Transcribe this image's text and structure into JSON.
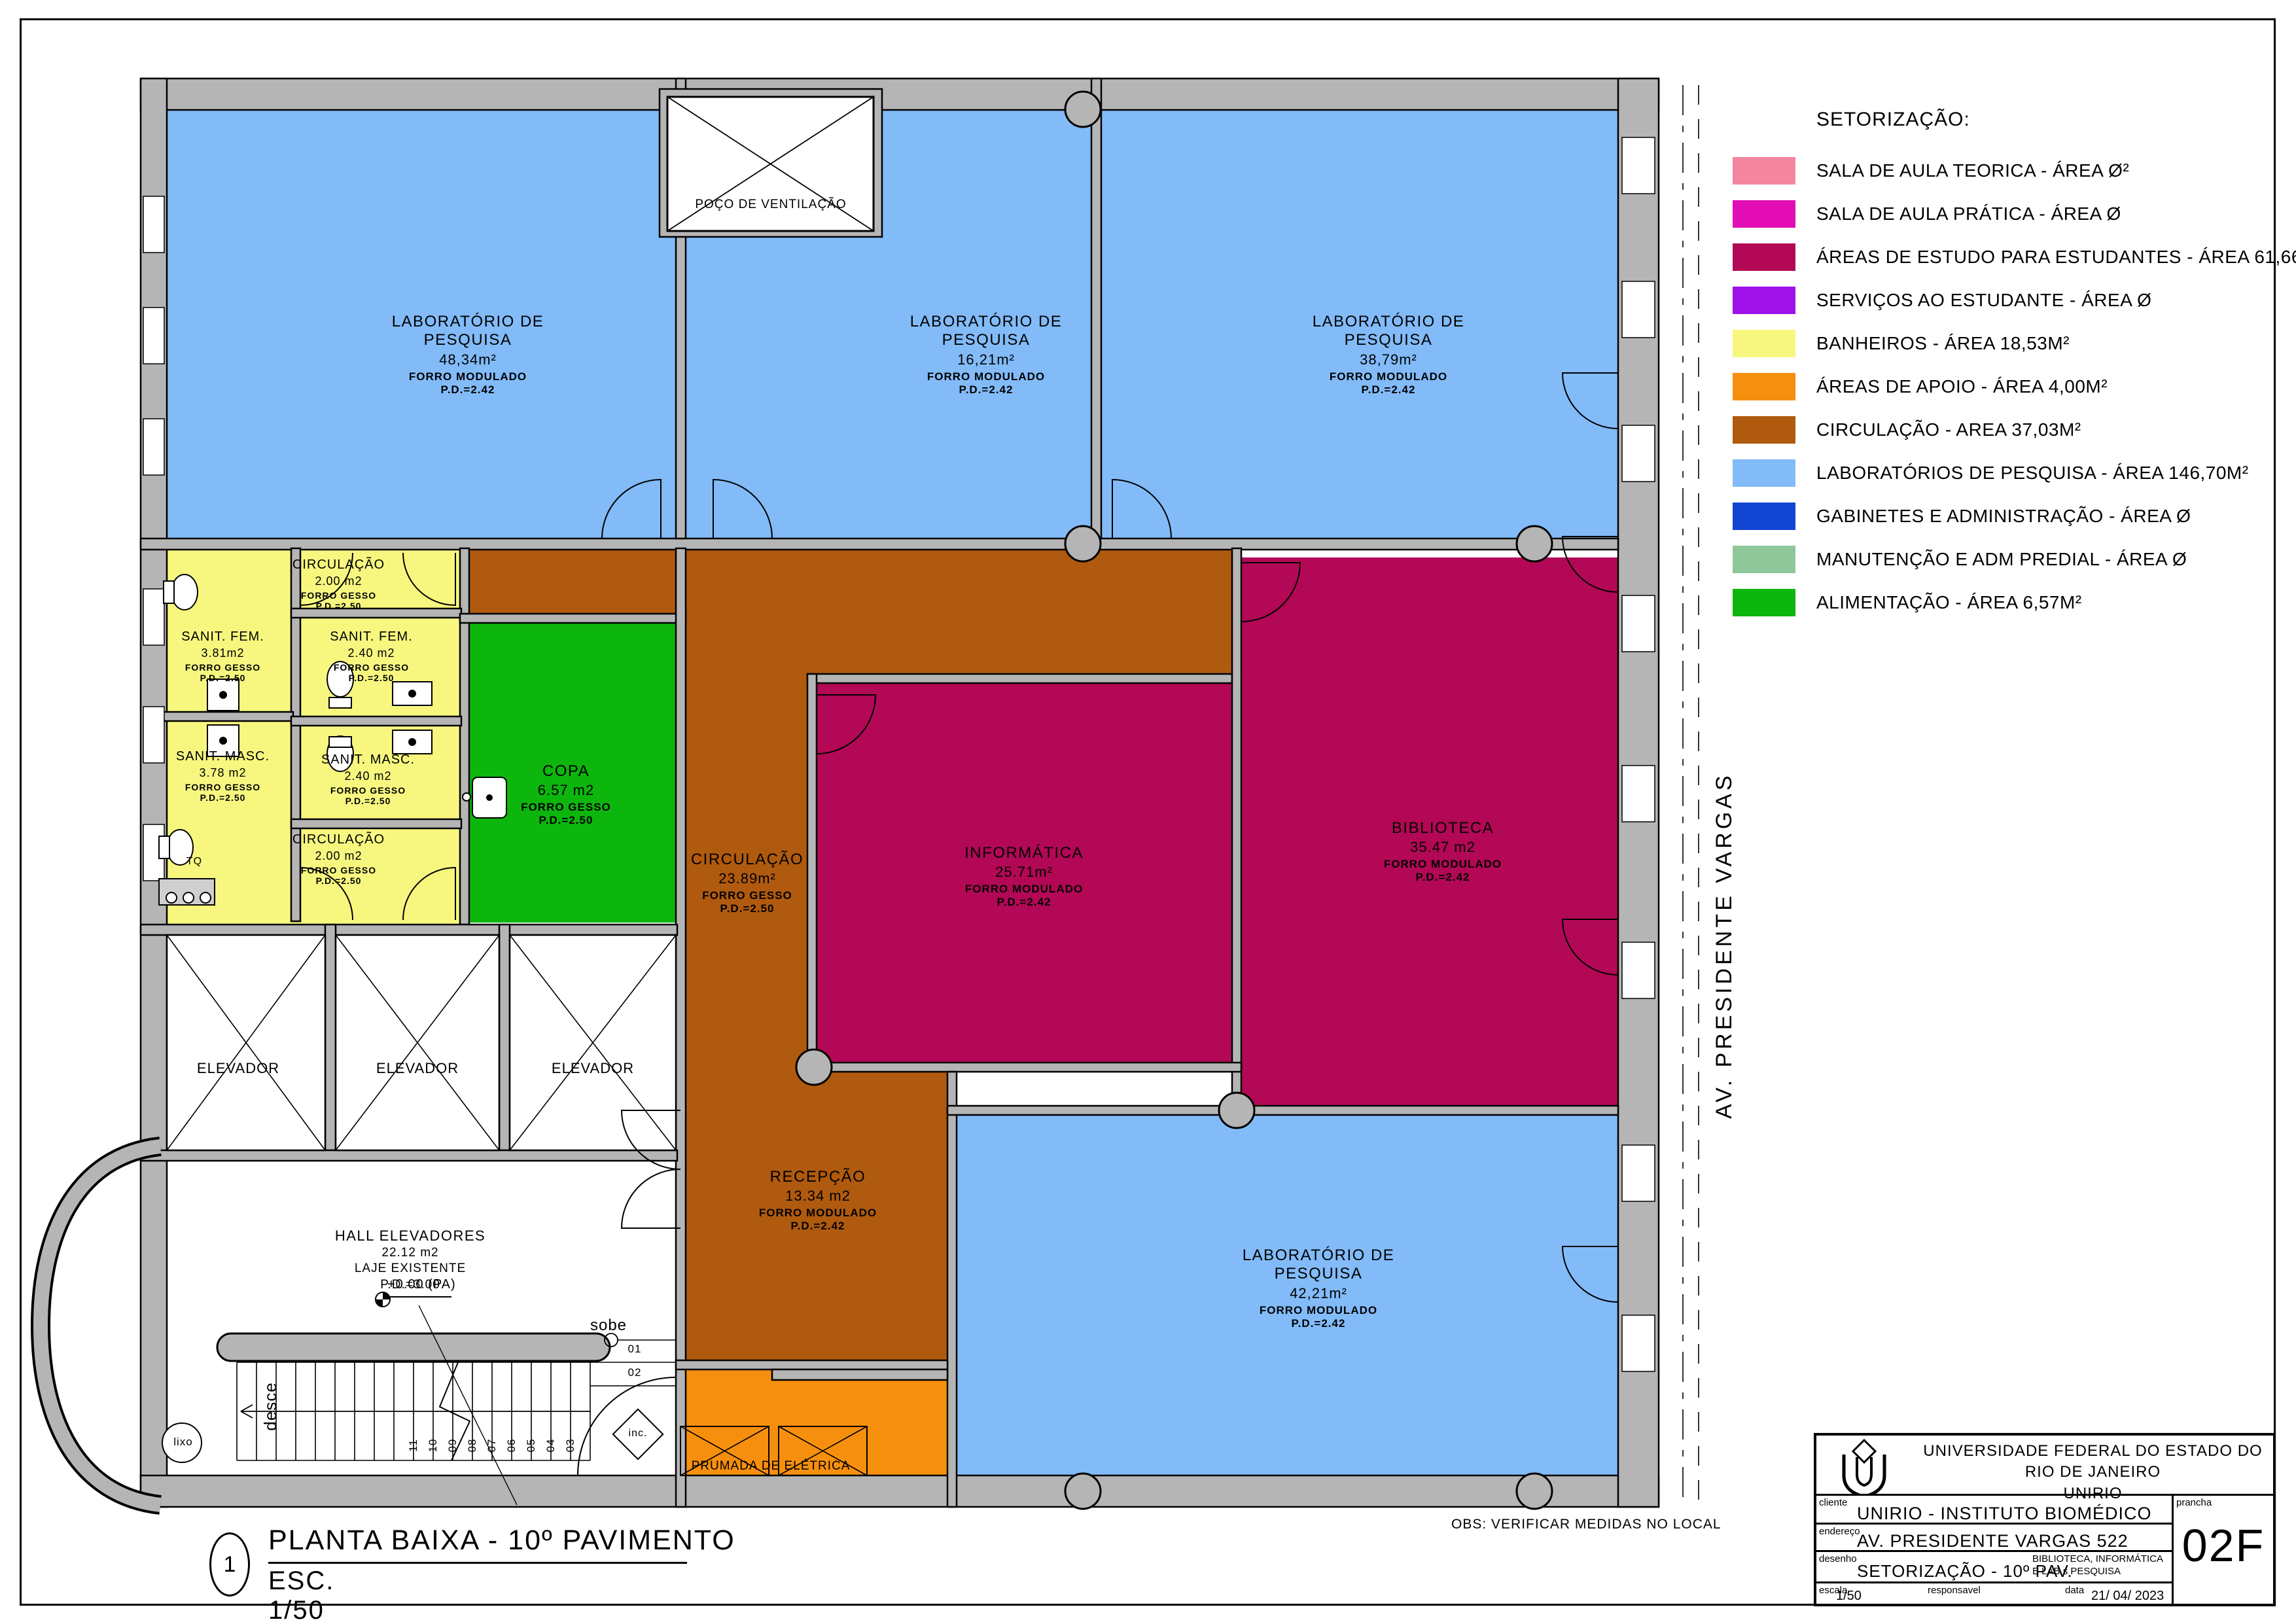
{
  "legend": {
    "title": "SETORIZAÇÃO:",
    "items": [
      {
        "label": "SALA DE AULA TEORICA - ÁREA Ø²",
        "color": "#f5859f"
      },
      {
        "label": "SALA DE AULA PRÁTICA - ÁREA Ø",
        "color": "#e20db4"
      },
      {
        "label": "ÁREAS DE ESTUDO PARA ESTUDANTES - ÁREA 61,66M²",
        "color": "#b20855"
      },
      {
        "label": "SERVIÇOS AO ESTUDANTE - ÁREA Ø",
        "color": "#a011ea"
      },
      {
        "label": "BANHEIROS  - ÁREA 18,53M²",
        "color": "#f7f780"
      },
      {
        "label": "ÁREAS DE APOIO - ÁREA 4,00M²",
        "color": "#f78f0e"
      },
      {
        "label": "CIRCULAÇÃO  - AREA 37,03M²",
        "color": "#b05a0f"
      },
      {
        "label": "LABORATÓRIOS DE PESQUISA - ÁREA 146,70M²",
        "color": "#82bbf8"
      },
      {
        "label": "GABINETES E ADMINISTRAÇÃO - ÁREA Ø",
        "color": "#1245d2"
      },
      {
        "label": "MANUTENÇÃO E ADM PREDIAL - ÁREA Ø",
        "color": "#8fc79a"
      },
      {
        "label": "ALIMENTAÇÃO - ÁREA 6,57M²",
        "color": "#0db60d"
      }
    ]
  },
  "plan": {
    "street_label": "AV. PRESIDENTE VARGAS",
    "poco_label": "POÇO DE VENTILAÇÃO",
    "prumada_label": "PRUMADA DE ELÉTRICA",
    "elevator_label": "ELEVADOR",
    "rooms": {
      "lab1": {
        "name": "LABORATÓRIO DE\nPESQUISA",
        "area": "48,34m²",
        "ceiling": "FORRO MODULADO",
        "pd": "P.D.=2.42"
      },
      "lab2": {
        "name": "LABORATÓRIO DE\nPESQUISA",
        "area": "16,21m²",
        "ceiling": "FORRO MODULADO",
        "pd": "P.D.=2.42"
      },
      "lab3": {
        "name": "LABORATÓRIO DE\nPESQUISA",
        "area": "38,79m²",
        "ceiling": "FORRO MODULADO",
        "pd": "P.D.=2.42"
      },
      "lab4": {
        "name": "LABORATÓRIO DE\nPESQUISA",
        "area": "42,21m²",
        "ceiling": "FORRO MODULADO",
        "pd": "P.D.=2.42"
      },
      "informatica": {
        "name": "INFORMÁTICA",
        "area": "25.71m²",
        "ceiling": "FORRO MODULADO",
        "pd": "P.D.=2.42"
      },
      "biblioteca": {
        "name": "BIBLIOTECA",
        "area": "35.47 m2",
        "ceiling": "FORRO MODULADO",
        "pd": "P.D.=2.42"
      },
      "copa": {
        "name": "COPA",
        "area": "6.57 m2",
        "ceiling": "FORRO GESSO",
        "pd": "P.D.=2.50"
      },
      "circulacao": {
        "name": "CIRCULAÇÃO",
        "area": "23.89m²",
        "ceiling": "FORRO GESSO",
        "pd": "P.D.=2.50"
      },
      "recepcao": {
        "name": "RECEPÇÃO",
        "area": "13.34 m2",
        "ceiling": "FORRO MODULADO",
        "pd": "P.D.=2.42"
      },
      "circ_wc_top": {
        "name": "CIRCULAÇÃO",
        "area": "2.00 m2",
        "ceiling": "FORRO GESSO",
        "pd": "P.D.=2.50"
      },
      "circ_wc_bottom": {
        "name": "CIRCULAÇÃO",
        "area": "2.00 m2",
        "ceiling": "FORRO GESSO",
        "pd": "P.D.=2.50"
      },
      "sanit_fem_a": {
        "name": "SANIT.  FEM.",
        "area": "3.81m2",
        "ceiling": "FORRO GESSO",
        "pd": "P.D.=2.50"
      },
      "sanit_fem_b": {
        "name": "SANIT.  FEM.",
        "area": "2.40 m2",
        "ceiling": "FORRO GESSO",
        "pd": "P.D.=2.50"
      },
      "sanit_masc_a": {
        "name": "SANIT.  MASC.",
        "area": "3.78 m2",
        "ceiling": "FORRO GESSO",
        "pd": "P.D.=2.50"
      },
      "sanit_masc_b": {
        "name": "SANIT.  MASC.",
        "area": "2.40 m2",
        "ceiling": "FORRO GESSO",
        "pd": "P.D.=2.50"
      }
    },
    "hall": {
      "name": "HALL  ELEVADORES",
      "area": "22.12 m2",
      "slab": "LAJE  EXISTENTE",
      "pd": "P.D.=3.00",
      "level": "+0.00  (PA)"
    },
    "stairs": {
      "sobe": "sobe",
      "desce": "desce",
      "inc": "inc.",
      "lixo": "lixo",
      "tq": "TQ",
      "steps_right": [
        "01",
        "02"
      ],
      "steps": [
        "03",
        "04",
        "05",
        "06",
        "07",
        "08",
        "09",
        "10",
        "11"
      ]
    }
  },
  "view_title": {
    "number": "1",
    "title": "PLANTA BAIXA - 10º PAVIMENTO",
    "scale": "ESC. 1/50"
  },
  "obs": "OBS: VERIFICAR MEDIDAS NO LOCAL",
  "titleblock": {
    "org_line1": "UNIVERSIDADE FEDERAL DO ESTADO DO RIO DE JANEIRO",
    "org_line2": "UNIRIO",
    "cliente_label": "cliente",
    "cliente_value": "UNIRIO - INSTITUTO BIOMÉDICO",
    "endereco_label": "endereço",
    "endereco_value": "AV. PRESIDENTE VARGAS 522",
    "desenho_label": "desenho",
    "desenho_value": "SETORIZAÇÃO - 10º PAV.",
    "desenho_extra": "BIBLIOTECA, INFORMÁTICA\nE LAB.s PESQUISA",
    "escala_label": "escala",
    "escala_value": "1/50",
    "responsavel_label": "responsavel",
    "data_label": "data",
    "data_value": "21/ 04/ 2023",
    "prancha_label": "prancha",
    "prancha_value": "02F"
  }
}
